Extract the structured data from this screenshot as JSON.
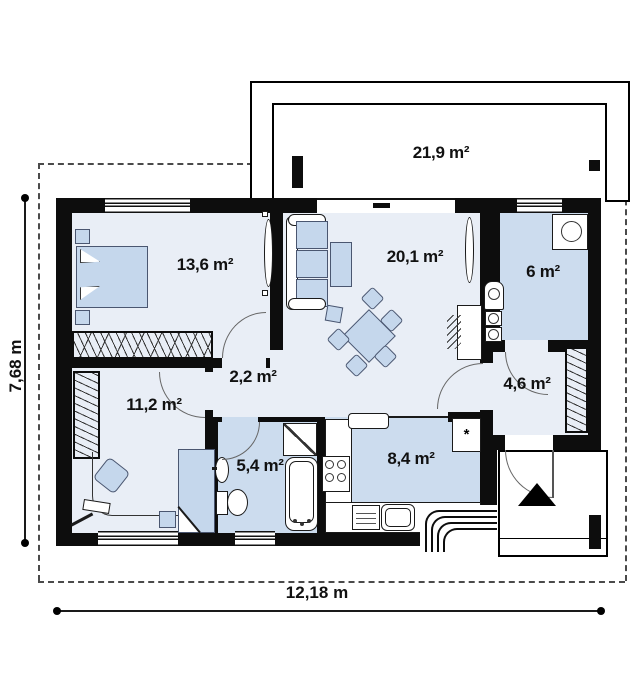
{
  "floor_plan": {
    "rooms": [
      {
        "name": "terrace",
        "area": "21,9 m²"
      },
      {
        "name": "bedroom",
        "area": "13,6 m²"
      },
      {
        "name": "living-room",
        "area": "20,1 m²"
      },
      {
        "name": "utility-room",
        "area": "6 m²"
      },
      {
        "name": "hallway",
        "area": "2,2 m²"
      },
      {
        "name": "bedroom-2",
        "area": "11,2 m²"
      },
      {
        "name": "entrance-hall",
        "area": "4,6 m²"
      },
      {
        "name": "bathroom",
        "area": "5,4 m²"
      },
      {
        "name": "kitchen",
        "area": "8,4 m²"
      }
    ],
    "dimensions": {
      "total_width": "12,18 m",
      "total_height": "7,68 m"
    },
    "symbols": {
      "fridge_star": "*"
    },
    "colors": {
      "wall": "#0d0d0d",
      "floor_light": "#e9eef6",
      "floor_blue": "#ccdcee",
      "furniture_blue": "#c5d7ec",
      "background": "#ffffff"
    }
  }
}
